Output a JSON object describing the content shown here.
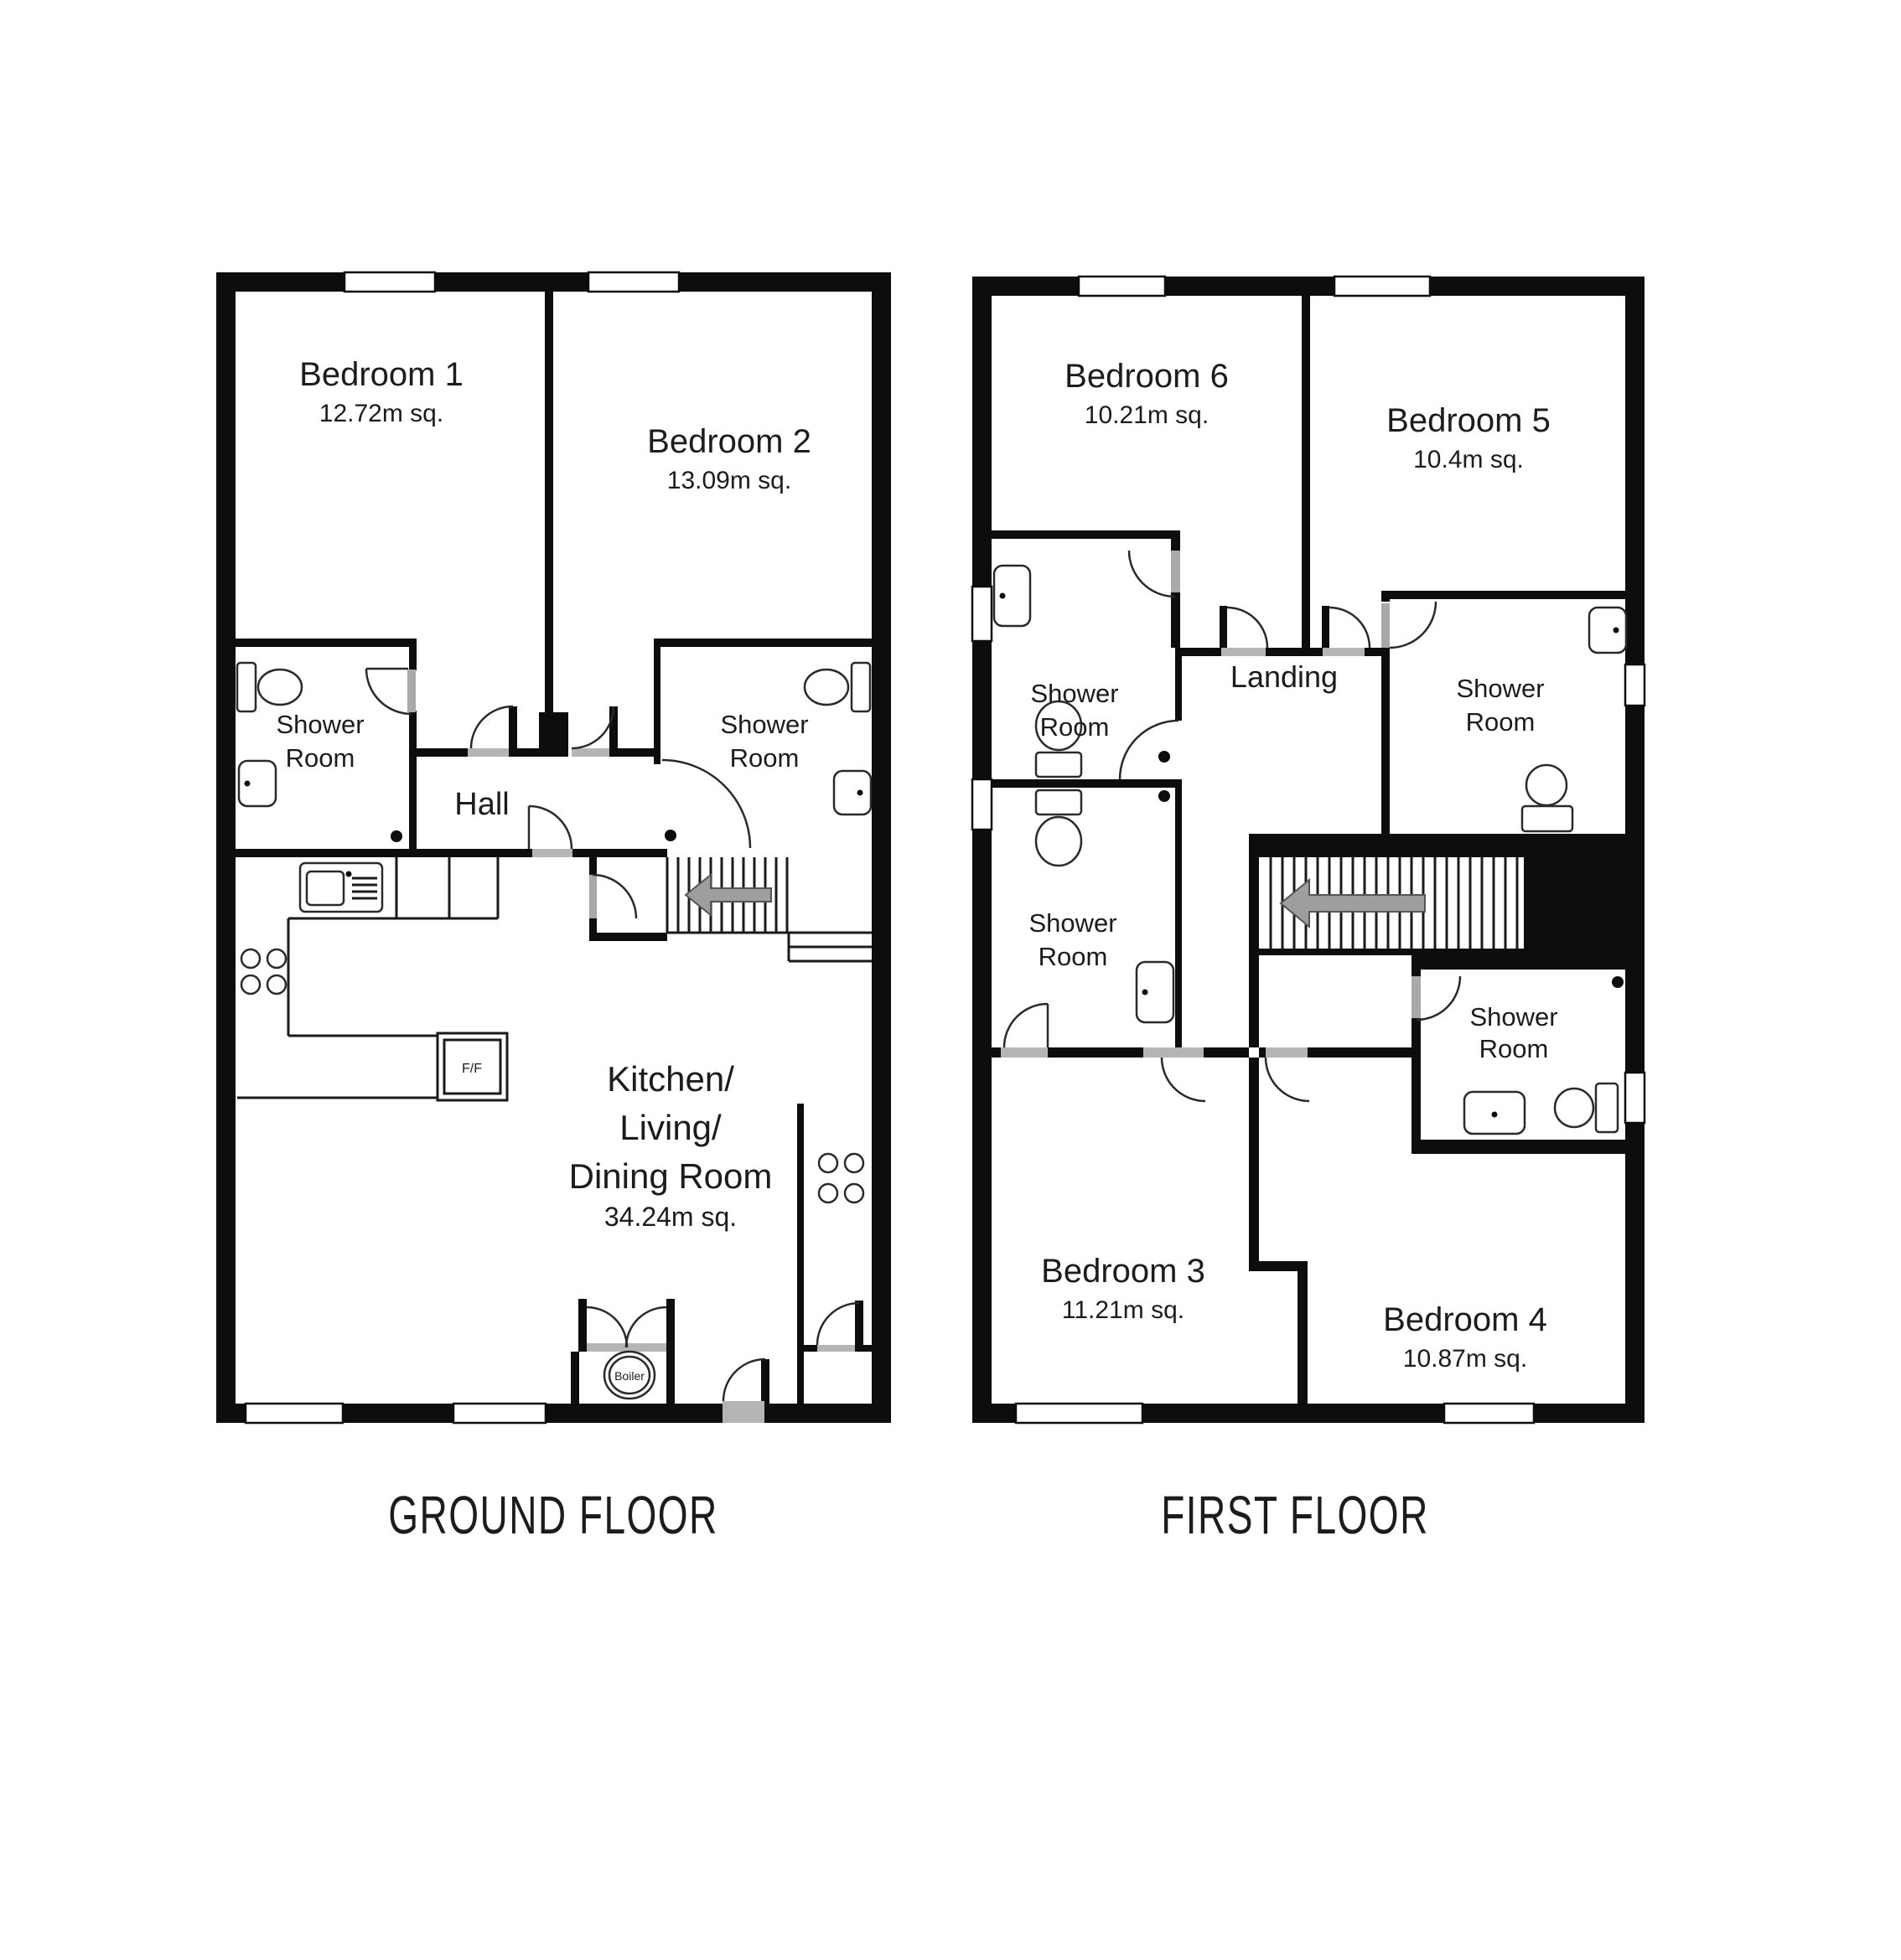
{
  "page": {
    "background": "#ffffff"
  },
  "colors": {
    "wall": "#0d0d0d",
    "door_leaf": "#a9a9a9",
    "threshold": "#b5b5b5",
    "arrow": "#9e9e9e",
    "text": "#1c1c1c"
  },
  "ground_floor": {
    "title": "GROUND FLOOR",
    "rooms": [
      {
        "id": "bedroom-1",
        "name": "Bedroom 1",
        "area": "12.72m sq."
      },
      {
        "id": "bedroom-2",
        "name": "Bedroom 2",
        "area": "13.09m sq."
      },
      {
        "id": "shower-room-left",
        "line1": "Shower",
        "line2": "Room"
      },
      {
        "id": "shower-room-right",
        "line1": "Shower",
        "line2": "Room"
      },
      {
        "id": "hall",
        "name": "Hall"
      },
      {
        "id": "kitchen-living-dining",
        "line1": "Kitchen/",
        "line2": "Living/",
        "line3": "Dining Room",
        "area": "34.24m sq."
      }
    ],
    "fixtures": {
      "fridge_freezer": "F/F",
      "boiler": "Boiler"
    }
  },
  "first_floor": {
    "title": "FIRST FLOOR",
    "rooms": [
      {
        "id": "bedroom-6",
        "name": "Bedroom 6",
        "area": "10.21m sq."
      },
      {
        "id": "bedroom-5",
        "name": "Bedroom 5",
        "area": "10.4m sq."
      },
      {
        "id": "shower-room-upper-left",
        "line1": "Shower",
        "line2": "Room"
      },
      {
        "id": "shower-room-lower-left",
        "line1": "Shower",
        "line2": "Room"
      },
      {
        "id": "shower-room-top-right",
        "line1": "Shower",
        "line2": "Room"
      },
      {
        "id": "shower-room-mid-right",
        "line1": "Shower",
        "line2": "Room"
      },
      {
        "id": "landing",
        "name": "Landing"
      },
      {
        "id": "bedroom-3",
        "name": "Bedroom 3",
        "area": "11.21m sq."
      },
      {
        "id": "bedroom-4",
        "name": "Bedroom 4",
        "area": "10.87m sq."
      }
    ]
  }
}
